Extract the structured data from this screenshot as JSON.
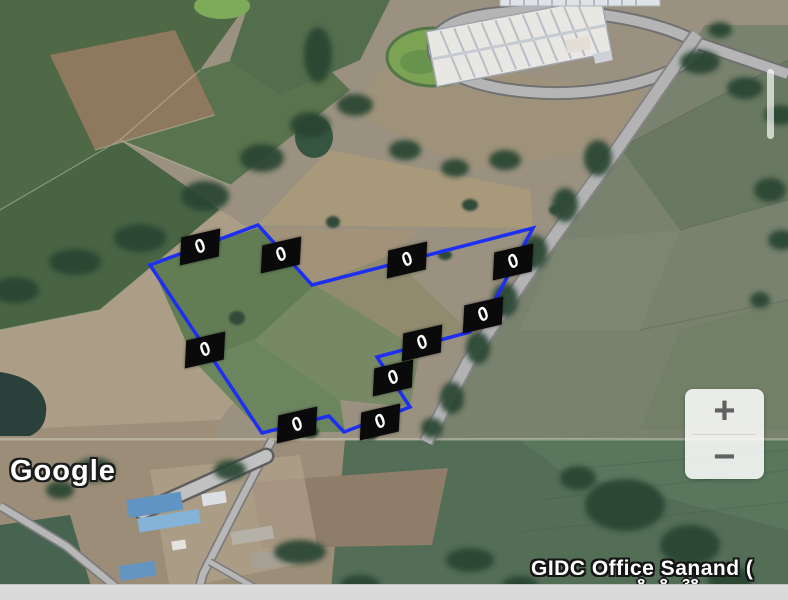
{
  "map": {
    "attribution_logo": "Google",
    "place_label": "GIDC Office Sanand (",
    "place_sublabel_partial": "8 8 38"
  },
  "controls": {
    "zoom_in_label": "+",
    "zoom_out_label": "−"
  },
  "parcel": {
    "polygon_color": "#1d2ff2",
    "marker_color": "#0a0a0a",
    "marker_text_color": "#ffffff",
    "vertices": [
      [
        258,
        225
      ],
      [
        150,
        265
      ],
      [
        262,
        433
      ],
      [
        329,
        416
      ],
      [
        344,
        432
      ],
      [
        410,
        407
      ],
      [
        377,
        357
      ],
      [
        470,
        332
      ],
      [
        495,
        300
      ],
      [
        533,
        228
      ],
      [
        312,
        285
      ]
    ],
    "edge_markers": [
      {
        "x": 200,
        "y": 247,
        "label": "0"
      },
      {
        "x": 205,
        "y": 350,
        "label": "0"
      },
      {
        "x": 297,
        "y": 425,
        "label": "0"
      },
      {
        "x": 380,
        "y": 422,
        "label": "0"
      },
      {
        "x": 393,
        "y": 378,
        "label": "0"
      },
      {
        "x": 422,
        "y": 343,
        "label": "0"
      },
      {
        "x": 483,
        "y": 315,
        "label": "0"
      },
      {
        "x": 513,
        "y": 262,
        "label": "0"
      },
      {
        "x": 407,
        "y": 260,
        "label": "0"
      },
      {
        "x": 281,
        "y": 255,
        "label": "0"
      }
    ]
  }
}
